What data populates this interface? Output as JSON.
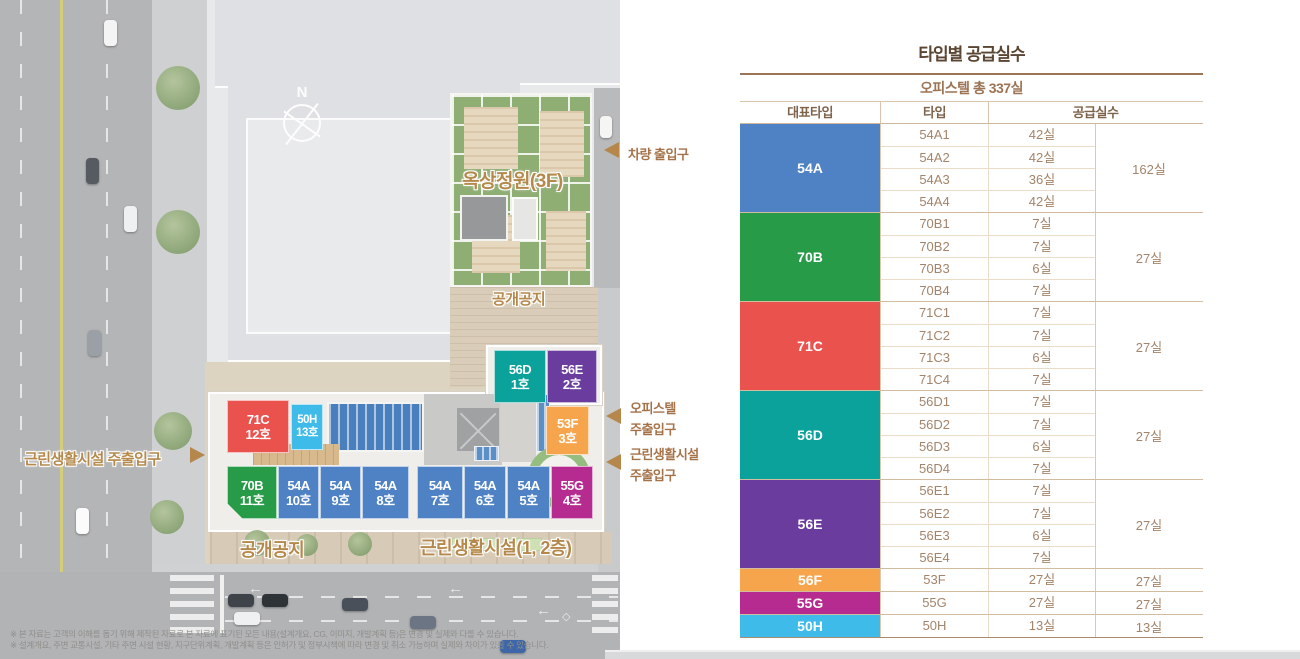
{
  "plan": {
    "compass": "N",
    "labels": {
      "vehicle_entrance": "차량 출입구",
      "rooftop_garden": "옥상정원(3F)",
      "open_space_upper": "공개공지",
      "officetel_entrance_line1": "오피스텔",
      "officetel_entrance_line2": "주출입구",
      "neighborhood_entrance_line1": "근린생활시설",
      "neighborhood_entrance_line2": "주출입구",
      "neighborhood_entrance_left": "근린생활시설 주출입구",
      "open_space_bottom": "공개공지",
      "neighborhood_floors": "근린생활시설(1, 2층)"
    },
    "units": [
      {
        "type": "56D",
        "no": "1호"
      },
      {
        "type": "56E",
        "no": "2호"
      },
      {
        "type": "53F",
        "no": "3호"
      },
      {
        "type": "55G",
        "no": "4호"
      },
      {
        "type": "54A",
        "no": "5호"
      },
      {
        "type": "54A",
        "no": "6호"
      },
      {
        "type": "54A",
        "no": "7호"
      },
      {
        "type": "54A",
        "no": "8호"
      },
      {
        "type": "54A",
        "no": "9호"
      },
      {
        "type": "54A",
        "no": "10호"
      },
      {
        "type": "70B",
        "no": "11호"
      },
      {
        "type": "71C",
        "no": "12호"
      },
      {
        "type": "50H",
        "no": "13호"
      }
    ],
    "footnotes": [
      "※ 본 자료는 고객의 이해를 돕기 위해 제작된 자료로 본 자료에 표기된 모든 내용(설계개요, CG, 이미지, 개발계획 등)은 변경 및 실제와 다를 수 있습니다.",
      "※ 설계개요, 주변 교통시설, 기타 주변 시설 현황, 지구단위계획, 개발계획 등은 인허가 및 정부시책에 따라 변경 및 취소 가능하며 실제와 차이가 있을 수 있습니다."
    ]
  },
  "table": {
    "title": "타입별 공급실수",
    "subtitle": "오피스텔 총 337실",
    "headers": {
      "rep_type": "대표타입",
      "type": "타입",
      "supply": "공급실수"
    },
    "groups": [
      {
        "rep": "54A",
        "total": "162실",
        "rows": [
          {
            "type": "54A1",
            "count": "42실"
          },
          {
            "type": "54A2",
            "count": "42실"
          },
          {
            "type": "54A3",
            "count": "36실"
          },
          {
            "type": "54A4",
            "count": "42실"
          }
        ]
      },
      {
        "rep": "70B",
        "total": "27실",
        "rows": [
          {
            "type": "70B1",
            "count": "7실"
          },
          {
            "type": "70B2",
            "count": "7실"
          },
          {
            "type": "70B3",
            "count": "6실"
          },
          {
            "type": "70B4",
            "count": "7실"
          }
        ]
      },
      {
        "rep": "71C",
        "total": "27실",
        "rows": [
          {
            "type": "71C1",
            "count": "7실"
          },
          {
            "type": "71C2",
            "count": "7실"
          },
          {
            "type": "71C3",
            "count": "6실"
          },
          {
            "type": "71C4",
            "count": "7실"
          }
        ]
      },
      {
        "rep": "56D",
        "total": "27실",
        "rows": [
          {
            "type": "56D1",
            "count": "7실"
          },
          {
            "type": "56D2",
            "count": "7실"
          },
          {
            "type": "56D3",
            "count": "6실"
          },
          {
            "type": "56D4",
            "count": "7실"
          }
        ]
      },
      {
        "rep": "56E",
        "total": "27실",
        "rows": [
          {
            "type": "56E1",
            "count": "7실"
          },
          {
            "type": "56E2",
            "count": "7실"
          },
          {
            "type": "56E3",
            "count": "6실"
          },
          {
            "type": "56E4",
            "count": "7실"
          }
        ]
      },
      {
        "rep": "56F",
        "total": "27실",
        "rows": [
          {
            "type": "53F",
            "count": "27실"
          }
        ]
      },
      {
        "rep": "55G",
        "total": "27실",
        "rows": [
          {
            "type": "55G",
            "count": "27실"
          }
        ]
      },
      {
        "rep": "50H",
        "total": "13실",
        "rows": [
          {
            "type": "50H",
            "count": "13실"
          }
        ]
      }
    ]
  },
  "colors": {
    "54A": "#4e82c4",
    "70B": "#279b47",
    "71C": "#ea524e",
    "56D": "#0aa29a",
    "56E": "#6a3c9e",
    "56F": "#f6a54d",
    "55G": "#b62b90",
    "50H": "#3fbbea",
    "table_title": "#5b4533",
    "table_text": "#a3846a",
    "table_border": "#d2bca0",
    "label_brown": "#a5734a",
    "arrow_tan": "#b5874b"
  },
  "chart_data": {
    "type": "table",
    "title": "타입별 공급실수",
    "subtitle": "오피스텔 총 337실",
    "columns": [
      "대표타입",
      "타입",
      "공급실수(타입)",
      "공급실수(합계)"
    ],
    "rows": [
      [
        "54A",
        "54A1",
        42,
        162
      ],
      [
        "54A",
        "54A2",
        42,
        162
      ],
      [
        "54A",
        "54A3",
        36,
        162
      ],
      [
        "54A",
        "54A4",
        42,
        162
      ],
      [
        "70B",
        "70B1",
        7,
        27
      ],
      [
        "70B",
        "70B2",
        7,
        27
      ],
      [
        "70B",
        "70B3",
        6,
        27
      ],
      [
        "70B",
        "70B4",
        7,
        27
      ],
      [
        "71C",
        "71C1",
        7,
        27
      ],
      [
        "71C",
        "71C2",
        7,
        27
      ],
      [
        "71C",
        "71C3",
        6,
        27
      ],
      [
        "71C",
        "71C4",
        7,
        27
      ],
      [
        "56D",
        "56D1",
        7,
        27
      ],
      [
        "56D",
        "56D2",
        7,
        27
      ],
      [
        "56D",
        "56D3",
        6,
        27
      ],
      [
        "56D",
        "56D4",
        7,
        27
      ],
      [
        "56E",
        "56E1",
        7,
        27
      ],
      [
        "56E",
        "56E2",
        7,
        27
      ],
      [
        "56E",
        "56E3",
        6,
        27
      ],
      [
        "56E",
        "56E4",
        7,
        27
      ],
      [
        "56F",
        "53F",
        27,
        27
      ],
      [
        "55G",
        "55G",
        27,
        27
      ],
      [
        "50H",
        "50H",
        13,
        13
      ]
    ],
    "total_units": 337
  }
}
